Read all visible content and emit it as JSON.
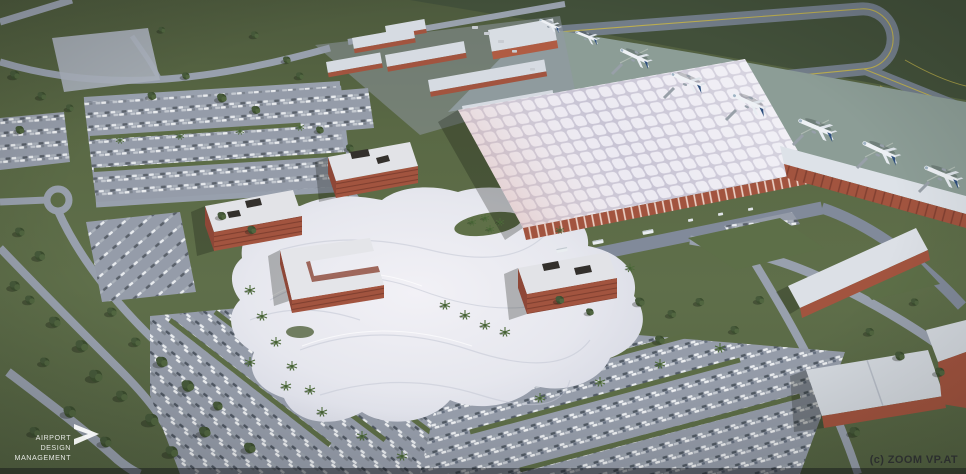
{
  "scene": {
    "description": "Aerial 3D architectural rendering of an airport campus: quilted-roof terminal with aircraft apron and taxiway loop, flowing white canopy plaza, red-brick office blocks, cargo buildings, warehouse and large car parks in green landscape"
  },
  "watermarks": {
    "studio_logo": {
      "icon": "chevron-right-icon",
      "line1": "AIRPORT",
      "line2": "DESIGN",
      "line3": "MANAGEMENT"
    },
    "credit": "(c) ZOOM VP.AT"
  },
  "palette": {
    "grass": "#5d6c46",
    "grass-dark": "#42503a",
    "road": "#98a0ad",
    "asphalt": "#959ca9",
    "apron": "#8c9d96",
    "taxiway": "#727d89",
    "taxi-line": "#c3b349",
    "brick": "#a2543f",
    "brick-dark": "#8a4535",
    "roof-light": "#d6dbe2",
    "canopy": "#e9e9ef",
    "tail-blue": "#2e4f7d",
    "tree": "#3c4e2f",
    "credit": "#2a2c2e",
    "logo": "#ffffff"
  }
}
